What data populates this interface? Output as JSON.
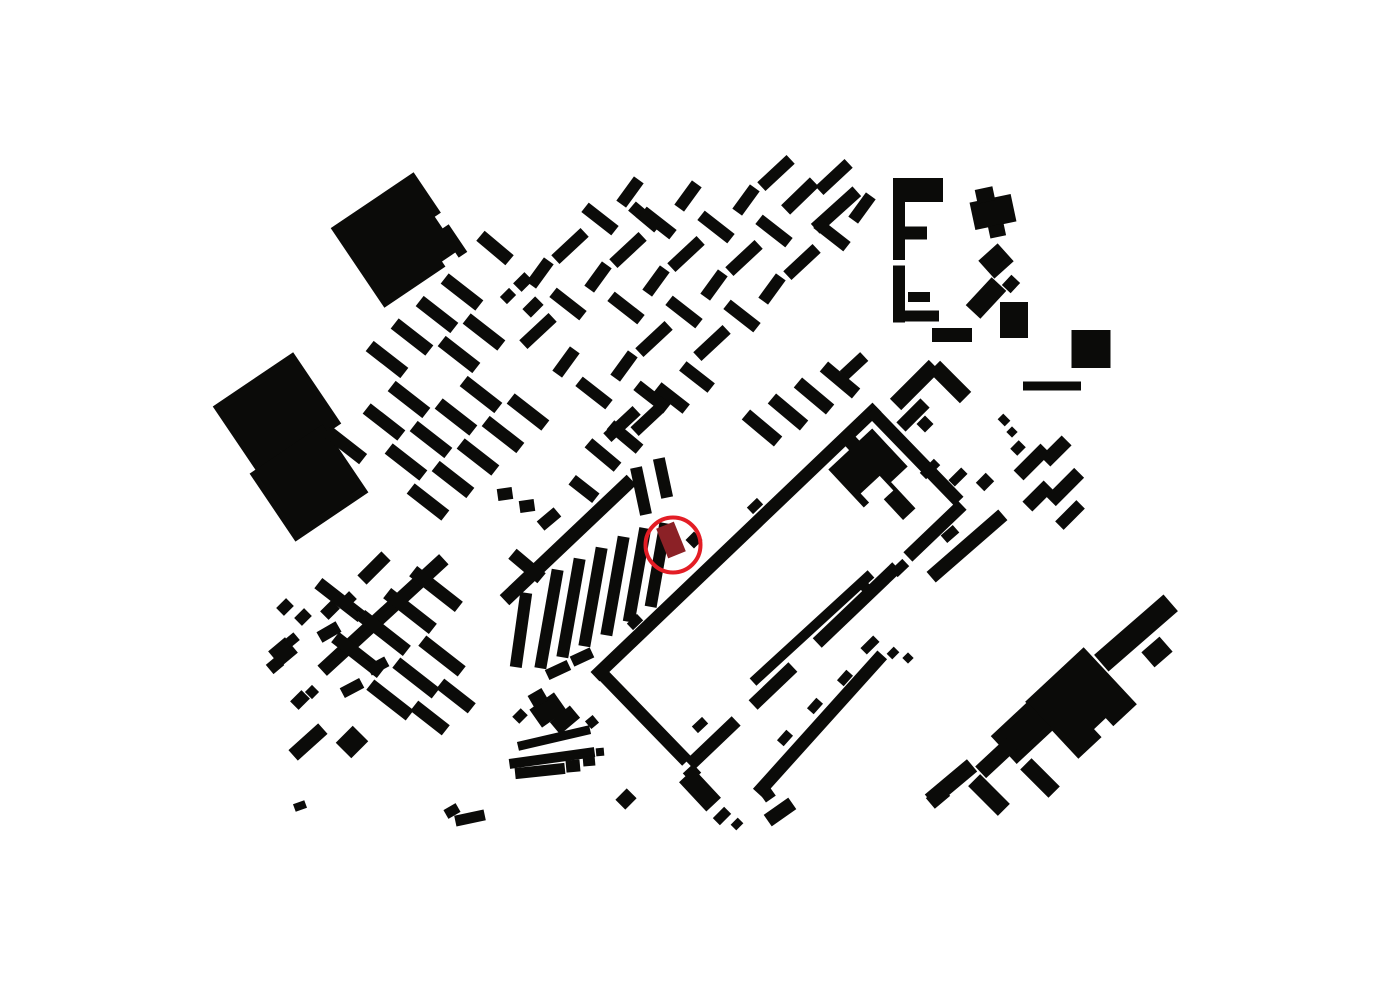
{
  "canvas": {
    "width": 1400,
    "height": 990,
    "background": "#ffffff",
    "building_color": "#0b0b09"
  },
  "highlight": {
    "circle": {
      "cx": 673,
      "cy": 545,
      "r": 27.5,
      "stroke": "#e31d25",
      "stroke_width": 4
    },
    "building": {
      "cx": 671,
      "cy": 540,
      "w": 19,
      "h": 32,
      "r": -22,
      "fill": "#8b2126"
    }
  },
  "buildings": [
    [
      399,
      240,
      100,
      96,
      -34
    ],
    [
      277,
      415,
      97,
      86,
      -34
    ],
    [
      309,
      483,
      88,
      82,
      -34
    ],
    [
      495,
      248,
      13,
      38,
      -50
    ],
    [
      523,
      282,
      16,
      12,
      -45
    ],
    [
      508,
      296,
      13,
      10,
      -45
    ],
    [
      533,
      307,
      18,
      12,
      -45
    ],
    [
      645,
      217,
      12,
      34,
      -50
    ],
    [
      800,
      196,
      40,
      13,
      -44
    ],
    [
      836,
      210,
      56,
      13,
      -42
    ],
    [
      899,
      219,
      12,
      82,
      0
    ],
    [
      921,
      190,
      44,
      24,
      0
    ],
    [
      916,
      233,
      22,
      13,
      0
    ],
    [
      899,
      294,
      12,
      57,
      0
    ],
    [
      919,
      297,
      22,
      10,
      0
    ],
    [
      922,
      316,
      34,
      11,
      0
    ],
    [
      952,
      335,
      40,
      14,
      0
    ],
    [
      993,
      212,
      42,
      28,
      -12
    ],
    [
      985,
      195,
      18,
      14,
      -12
    ],
    [
      997,
      231,
      16,
      12,
      -12
    ],
    [
      996,
      261,
      26,
      24,
      -42
    ],
    [
      986,
      298,
      38,
      20,
      -47
    ],
    [
      1011,
      284,
      14,
      12,
      -47
    ],
    [
      1014,
      320,
      28,
      36,
      0
    ],
    [
      1091,
      349,
      39,
      38,
      0
    ],
    [
      1052,
      386,
      58,
      9,
      0
    ],
    [
      915,
      385,
      55,
      16,
      -45
    ],
    [
      950,
      382,
      16,
      44,
      -45
    ],
    [
      913,
      415,
      34,
      13,
      -45
    ],
    [
      925,
      424,
      12,
      12,
      -45
    ],
    [
      930,
      469,
      20,
      9,
      -45
    ],
    [
      958,
      477,
      18,
      9,
      -45
    ],
    [
      985,
      482,
      14,
      12,
      -45
    ],
    [
      967,
      546,
      95,
      14,
      -41
    ],
    [
      950,
      534,
      16,
      10,
      -41
    ],
    [
      1032,
      462,
      38,
      14,
      -45
    ],
    [
      1056,
      451,
      14,
      30,
      45
    ],
    [
      1065,
      487,
      40,
      14,
      -45
    ],
    [
      1038,
      496,
      14,
      30,
      45
    ],
    [
      1070,
      515,
      30,
      12,
      -45
    ],
    [
      1004,
      420,
      10,
      8,
      45
    ],
    [
      1012,
      432,
      8,
      8,
      45
    ],
    [
      1018,
      448,
      12,
      10,
      -45
    ],
    [
      736,
      542,
      390,
      13,
      -43.7
    ],
    [
      915,
      456,
      126,
      13,
      45.9
    ],
    [
      643,
      716,
      126,
      13,
      45.9
    ],
    [
      935,
      531,
      75,
      13,
      -43.7
    ],
    [
      857,
      605,
      110,
      13,
      -43.7
    ],
    [
      773,
      686,
      55,
      13,
      -43.7
    ],
    [
      713,
      743,
      64,
      13,
      -43.7
    ],
    [
      900,
      568,
      16,
      10,
      -43.7
    ],
    [
      868,
      590,
      14,
      10,
      46
    ],
    [
      635,
      622,
      14,
      9,
      -43.7
    ],
    [
      755,
      506,
      14,
      9,
      -43.7
    ],
    [
      868,
      468,
      60,
      52,
      -43
    ],
    [
      897,
      501,
      17,
      36,
      -43
    ],
    [
      852,
      443,
      14,
      12,
      -43
    ],
    [
      812,
      628,
      160,
      10,
      -42.5
    ],
    [
      700,
      725,
      14,
      9,
      -43
    ],
    [
      820,
      724,
      186,
      13,
      -48
    ],
    [
      785,
      738,
      14,
      9,
      -48
    ],
    [
      815,
      706,
      14,
      9,
      -48
    ],
    [
      845,
      678,
      14,
      9,
      -48
    ],
    [
      870,
      645,
      18,
      9,
      -45
    ],
    [
      893,
      653,
      10,
      8,
      -45
    ],
    [
      908,
      658,
      8,
      8,
      -45
    ],
    [
      700,
      790,
      20,
      40,
      -43
    ],
    [
      692,
      773,
      14,
      12,
      -43
    ],
    [
      722,
      816,
      16,
      10,
      -45
    ],
    [
      737,
      824,
      10,
      8,
      -45
    ],
    [
      780,
      812,
      30,
      14,
      -35
    ],
    [
      768,
      795,
      12,
      10,
      -35
    ],
    [
      1136,
      633,
      92,
      22,
      -41
    ],
    [
      1157,
      652,
      24,
      20,
      -41
    ],
    [
      1081,
      703,
      80,
      78,
      -43
    ],
    [
      1022,
      733,
      50,
      38,
      -43
    ],
    [
      996,
      758,
      42,
      16,
      -43
    ],
    [
      951,
      783,
      55,
      16,
      -40
    ],
    [
      989,
      795,
      17,
      42,
      -45
    ],
    [
      1040,
      778,
      16,
      40,
      -45
    ],
    [
      938,
      797,
      20,
      14,
      -40
    ],
    [
      383,
      615,
      165,
      14,
      -42.5
    ],
    [
      568,
      540,
      175,
      14,
      -43.5
    ],
    [
      549,
      619,
      12,
      100,
      10
    ],
    [
      571,
      608,
      12,
      100,
      10
    ],
    [
      593,
      597,
      12,
      100,
      10
    ],
    [
      615,
      586,
      12,
      100,
      10
    ],
    [
      637,
      575,
      12,
      95,
      10
    ],
    [
      658,
      565,
      12,
      85,
      10
    ],
    [
      521,
      630,
      12,
      75,
      8
    ],
    [
      527,
      566,
      13,
      38,
      -50
    ],
    [
      558,
      670,
      24,
      11,
      -25
    ],
    [
      582,
      657,
      22,
      11,
      -25
    ],
    [
      641,
      491,
      12,
      48,
      -12
    ],
    [
      663,
      478,
      12,
      40,
      -12
    ],
    [
      505,
      494,
      15,
      12,
      -8
    ],
    [
      527,
      506,
      15,
      12,
      -8
    ],
    [
      549,
      519,
      22,
      12,
      -40
    ],
    [
      603,
      455,
      12,
      38,
      -50
    ],
    [
      625,
      437,
      12,
      38,
      -50
    ],
    [
      647,
      420,
      34,
      12,
      -43
    ],
    [
      672,
      398,
      12,
      36,
      -52
    ],
    [
      697,
      377,
      12,
      36,
      -52
    ],
    [
      694,
      540,
      12,
      12,
      -45
    ],
    [
      584,
      489,
      12,
      30,
      -52
    ],
    [
      762,
      428,
      13,
      42,
      -50
    ],
    [
      788,
      412,
      13,
      42,
      -50
    ],
    [
      814,
      396,
      13,
      42,
      -50
    ],
    [
      840,
      380,
      13,
      42,
      -50
    ],
    [
      854,
      366,
      28,
      12,
      -43
    ],
    [
      374,
      568,
      34,
      13,
      -45
    ],
    [
      285,
      607,
      14,
      11,
      -45
    ],
    [
      303,
      617,
      14,
      11,
      -45
    ],
    [
      330,
      610,
      16,
      12,
      -45
    ],
    [
      348,
      600,
      14,
      11,
      -45
    ],
    [
      283,
      652,
      22,
      20,
      -40
    ],
    [
      275,
      665,
      14,
      12,
      -40
    ],
    [
      292,
      640,
      12,
      10,
      -40
    ],
    [
      300,
      700,
      16,
      12,
      -45
    ],
    [
      312,
      692,
      10,
      10,
      -45
    ],
    [
      308,
      742,
      40,
      14,
      -42
    ],
    [
      352,
      742,
      24,
      22,
      -45
    ],
    [
      300,
      806,
      12,
      8,
      -20
    ],
    [
      554,
      738,
      74,
      9,
      -13
    ],
    [
      552,
      758,
      86,
      10,
      -8
    ],
    [
      540,
      771,
      50,
      11,
      -6
    ],
    [
      573,
      766,
      14,
      12,
      -5
    ],
    [
      589,
      761,
      12,
      10,
      -5
    ],
    [
      600,
      752,
      8,
      8,
      -5
    ],
    [
      548,
      710,
      30,
      22,
      -35
    ],
    [
      565,
      720,
      26,
      16,
      -40
    ],
    [
      538,
      698,
      16,
      14,
      -30
    ],
    [
      520,
      716,
      12,
      10,
      -45
    ],
    [
      626,
      799,
      16,
      14,
      -45
    ],
    [
      470,
      818,
      30,
      11,
      -12
    ],
    [
      452,
      811,
      14,
      10,
      -30
    ],
    [
      592,
      722,
      10,
      10,
      -40
    ],
    [
      358,
      655,
      13,
      58,
      -52
    ],
    [
      384,
      633,
      13,
      58,
      -52
    ],
    [
      410,
      611,
      13,
      58,
      -52
    ],
    [
      436,
      589,
      13,
      58,
      -52
    ],
    [
      352,
      688,
      22,
      11,
      -28
    ],
    [
      378,
      666,
      20,
      11,
      -28
    ],
    [
      390,
      700,
      13,
      50,
      -52
    ],
    [
      416,
      678,
      13,
      50,
      -52
    ],
    [
      442,
      656,
      13,
      50,
      -52
    ],
    [
      430,
      718,
      13,
      40,
      -52
    ],
    [
      456,
      696,
      13,
      40,
      -52
    ],
    [
      340,
      600,
      13,
      55,
      -52
    ],
    [
      329,
      632,
      22,
      12,
      -30
    ],
    [
      345,
      445,
      13,
      46,
      -52
    ]
  ],
  "notches": [
    [
      447,
      217,
      20,
      14,
      -34
    ],
    [
      452,
      262,
      16,
      12,
      -34
    ],
    [
      877,
      492,
      26,
      20,
      -43
    ],
    [
      1104,
      728,
      16,
      12,
      -43
    ]
  ],
  "grids": [
    {
      "origin": [
        362,
        382
      ],
      "u": [
        25,
        -22.5
      ],
      "v": [
        22,
        40
      ],
      "ni": 5,
      "nj": 4,
      "variants": [
        [
          13,
          44,
          -52
        ]
      ],
      "skip": [
        3,
        4,
        10
      ]
    },
    {
      "origin": [
        510,
        300
      ],
      "u": [
        30,
        -27
      ],
      "v": [
        28,
        31
      ],
      "ni": 9,
      "nj": 5,
      "variants": [
        [
          12,
          38,
          -52
        ],
        [
          40,
          12,
          -43
        ],
        [
          12,
          30,
          36
        ]
      ],
      "skip": [
        5,
        3,
        11
      ],
      "min_y": 172,
      "max_x": 886,
      "wall": {
        "x0": 600,
        "y0": 672,
        "slope": -0.9559,
        "margin": 28
      }
    }
  ]
}
